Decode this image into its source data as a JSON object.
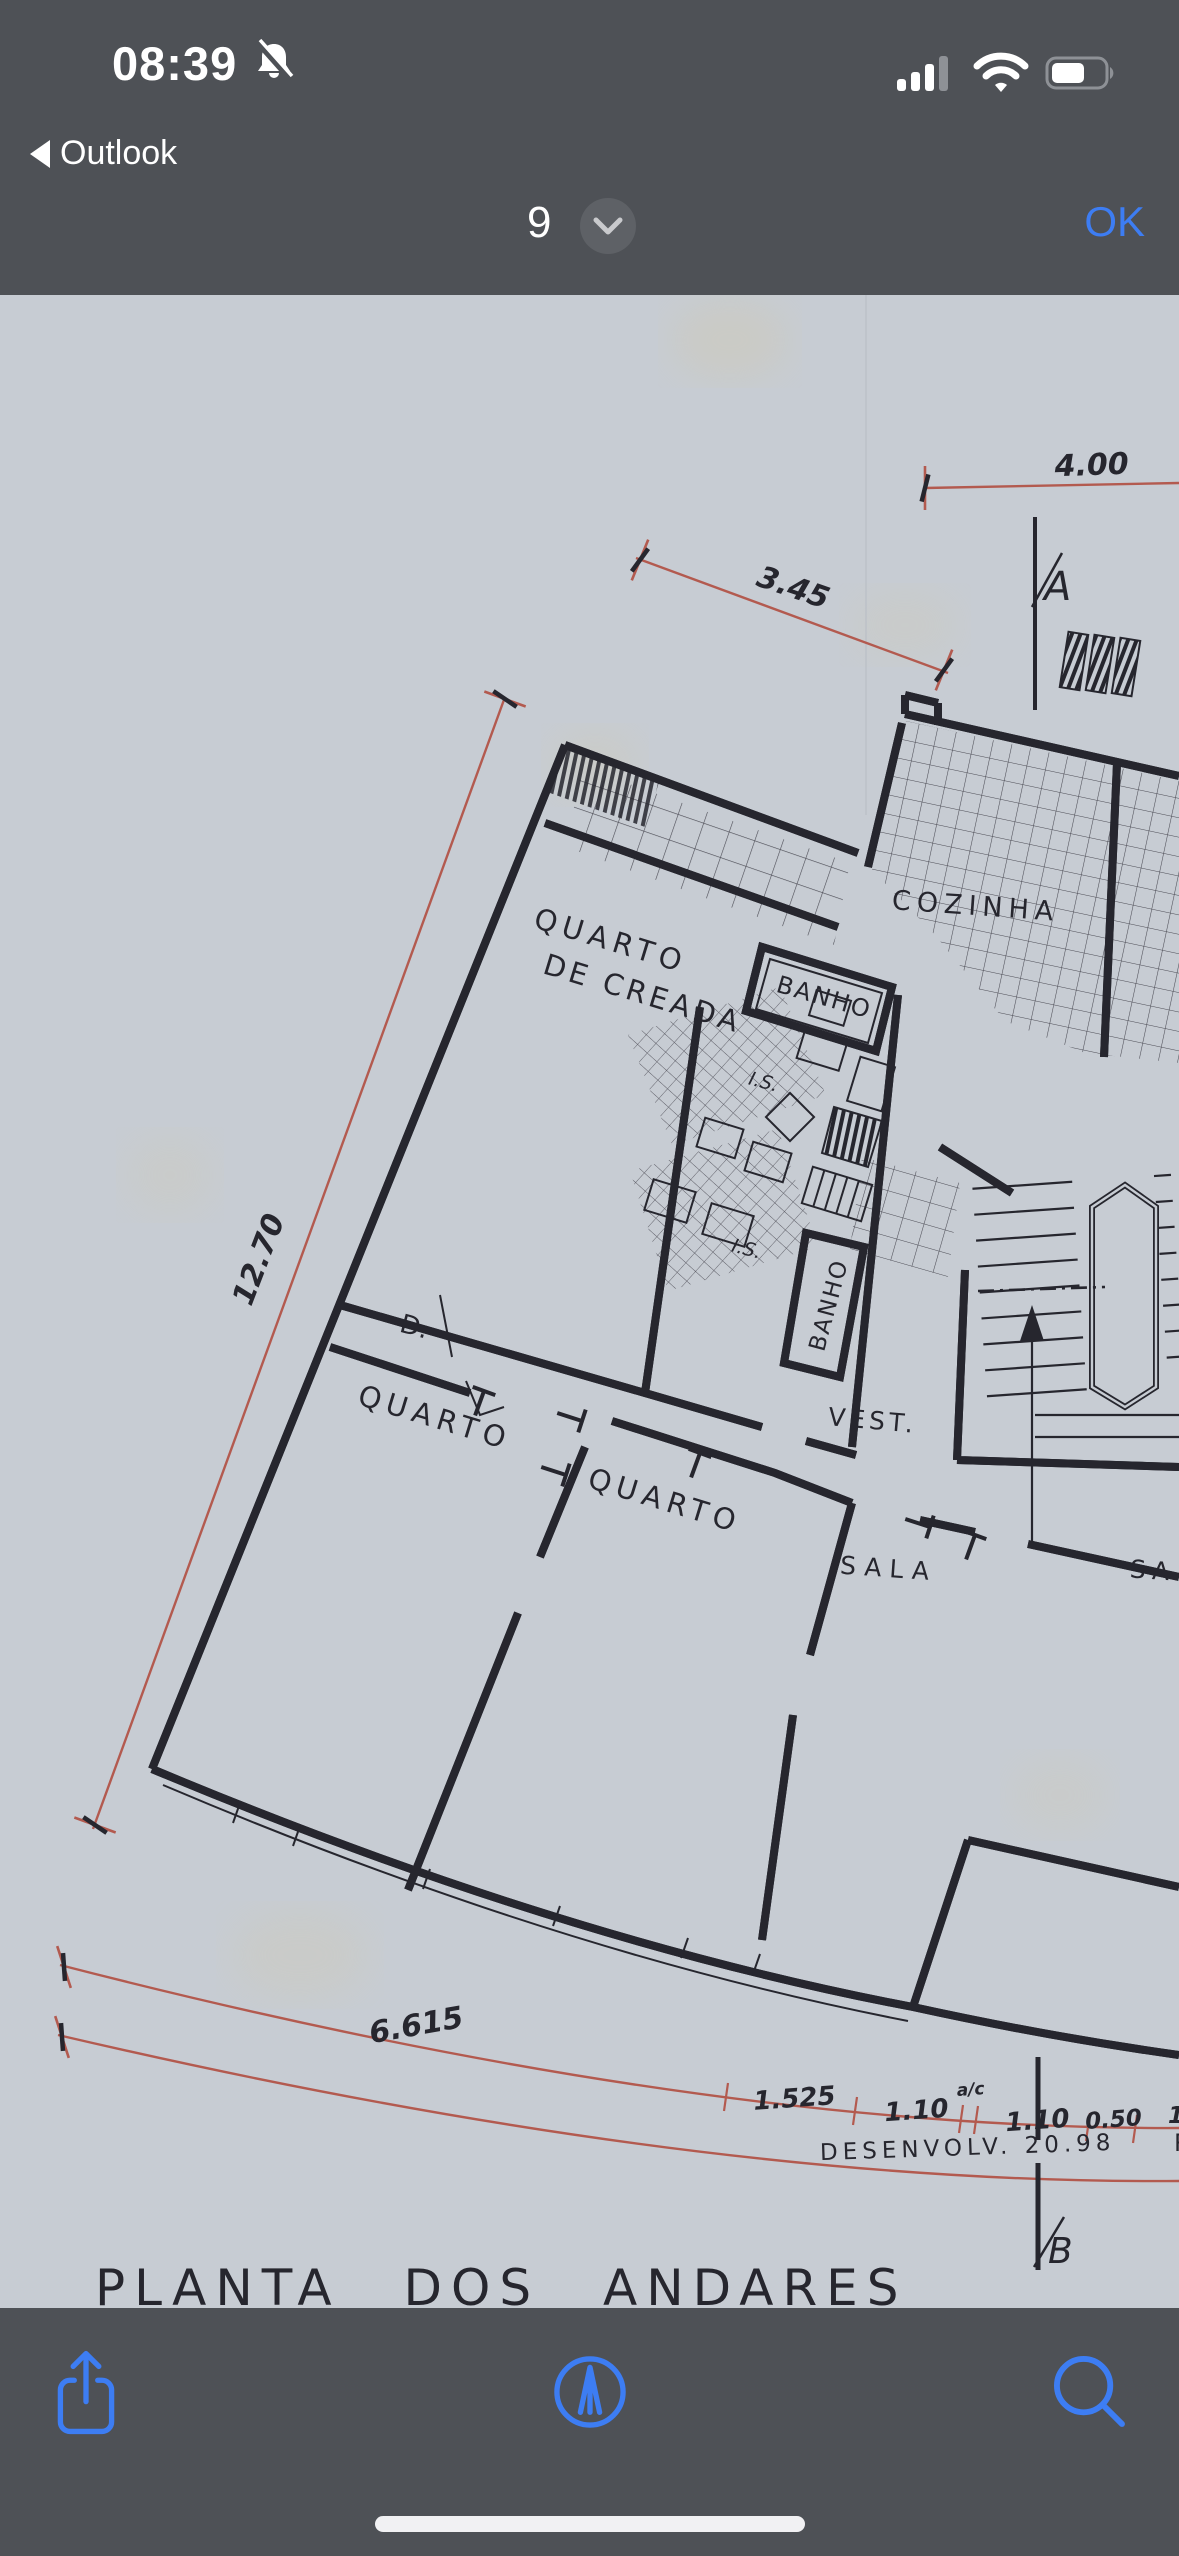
{
  "status_bar": {
    "time": "08:39",
    "silent_icon": "bell-slash",
    "back_app": "Outlook",
    "signal": "3-of-4-bars",
    "wifi": "full",
    "battery_visual_percent": "60"
  },
  "nav_bar": {
    "page_indicator": "9",
    "expand_icon": "chevron-down",
    "confirm_label": "OK"
  },
  "floor_plan": {
    "title": "PLANTA  DOS  ANDARES",
    "rooms": {
      "maid_line1": "QUARTO",
      "maid_line2": "DE CREADA",
      "bath_top": "BANHO",
      "kitchen": "COZINHA",
      "wc_upper": "I.S.",
      "wc_lower": "I.S.",
      "bath_main": "BANHO",
      "closet": "D.",
      "bedroom_left": "QUARTO",
      "bedroom_center": "QUARTO",
      "vestibule": "VEST.",
      "living": "SALA",
      "living_partial": "SA"
    },
    "dimensions": {
      "top": "4.00",
      "upper_diagonal": "3.45",
      "left_diagonal": "12.70",
      "bottom_arc": "6.615",
      "seg1": "1.525",
      "seg2": "1.10",
      "seg2_note": "a/c",
      "seg3": "1.10",
      "seg4": "0.50",
      "seg5_partial": "1",
      "development": "DESENVOLV.  20.98",
      "development_partial": "R"
    },
    "section_markers": {
      "top": "A",
      "bottom": "B"
    }
  },
  "toolbar": {
    "icons": [
      "share",
      "markup-compass",
      "search"
    ]
  },
  "colors": {
    "bar_gray": "#4e5156",
    "accent_blue": "#3d7df3",
    "paper": "#c7ccd3",
    "ink": "#26262e",
    "dimension_red": "#b35a4f"
  }
}
